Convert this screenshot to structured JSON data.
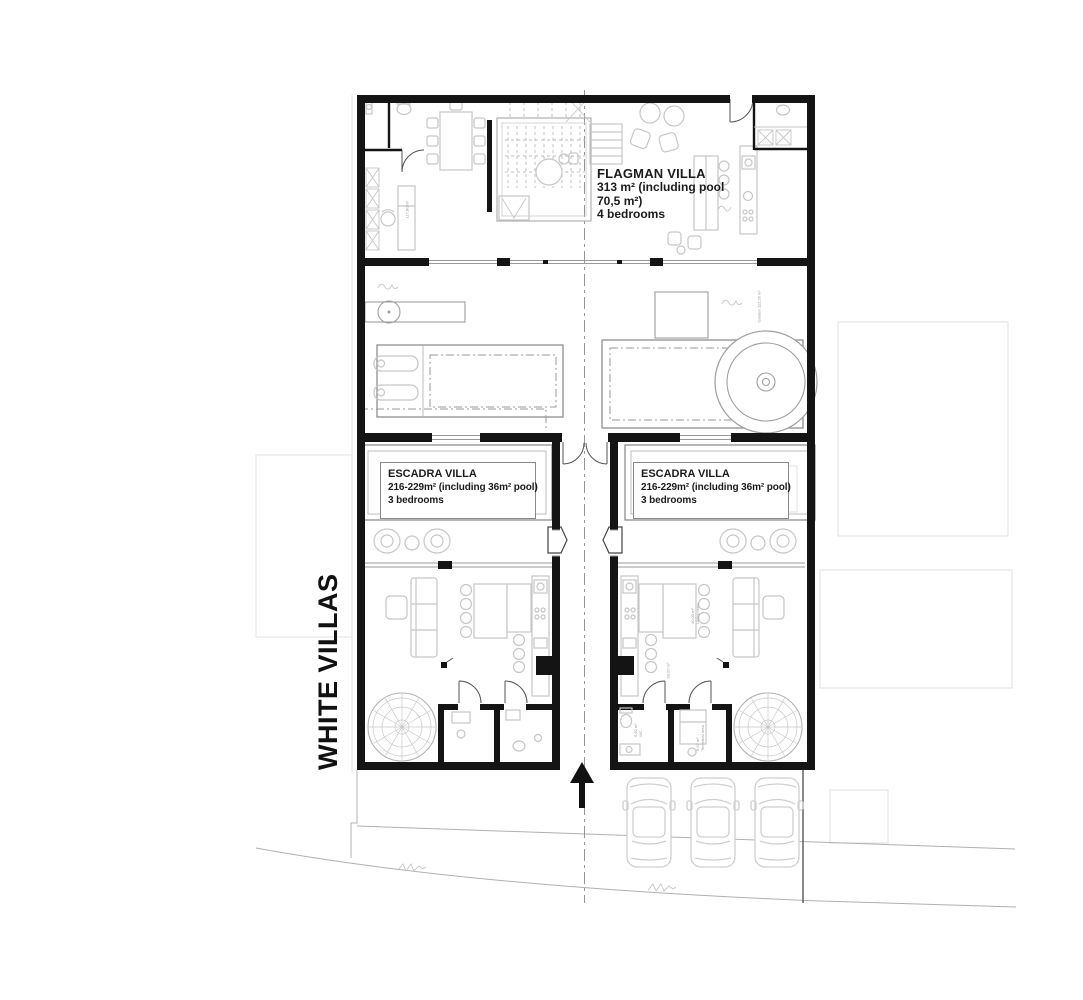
{
  "site": {
    "title": "WHITE VILLAS",
    "garden_note": "Garden 112,26 m²"
  },
  "flagman_villa": {
    "name": "FLAGMAN VILLA",
    "area_line1": "313 m² (including pool",
    "area_line2": "70,5 m²)",
    "bedrooms": "4 bedrooms",
    "room_note": "117,80 m²"
  },
  "escadra_villa_left": {
    "name": "ESCADRA VILLA",
    "area": "216-229m² (including 36m² pool)",
    "bedrooms": "3 bedrooms"
  },
  "escadra_villa_right": {
    "name": "ESCADRA VILLA",
    "area": "216-229m² (including 36m² pool)",
    "bedrooms": "3 bedrooms",
    "living_note_area": "40,00 m²",
    "living_note_label": "Living room",
    "kitchen_note": "90,20 m²",
    "wc_note_area": "5,60 m²",
    "wc_note_label": "WC",
    "tech_note_area": "5,97 m²",
    "tech_note_label": "Technical area"
  },
  "colors": {
    "wall": "#141414",
    "furniture_line": "#c6c6c6",
    "pool_line": "#8f8f8f",
    "boundary_faint": "#e6e6e6",
    "text": "#1b1b1b"
  }
}
